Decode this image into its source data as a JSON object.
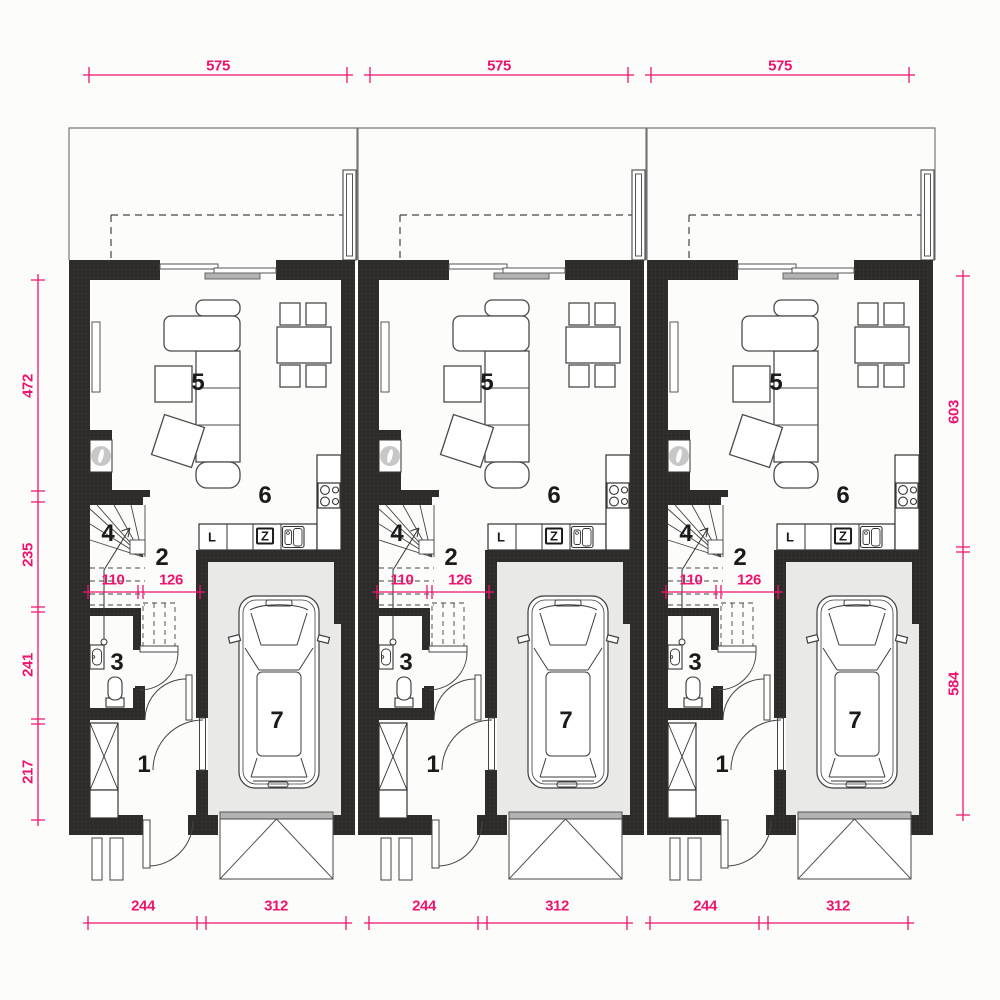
{
  "drawing": "ground floor plan of three identical terraced house units",
  "colors": {
    "dimension": "#ee146e",
    "wall": "#2d2c2a",
    "garage_floor": "#e9e9e7",
    "door_panel": "#b3b3b3",
    "background": "#fcfcfa"
  },
  "side_dims": {
    "left": [
      {
        "value": "472"
      },
      {
        "value": "235"
      },
      {
        "value": "241"
      },
      {
        "value": "217"
      }
    ],
    "right": [
      {
        "value": "603"
      },
      {
        "value": "584"
      }
    ]
  },
  "units": [
    {
      "rooms": {
        "r1": "1",
        "r2": "2",
        "r3": "3",
        "r4": "4",
        "r5": "5",
        "r6": "6",
        "r7": "7"
      },
      "kitchen": {
        "fridge": "L",
        "sink_unit": "Z"
      },
      "dims": {
        "width": "575",
        "front_left": "244",
        "front_right": "312",
        "stair": "110",
        "hall": "126"
      }
    },
    {
      "rooms": {
        "r1": "1",
        "r2": "2",
        "r3": "3",
        "r4": "4",
        "r5": "5",
        "r6": "6",
        "r7": "7"
      },
      "kitchen": {
        "fridge": "L",
        "sink_unit": "Z"
      },
      "dims": {
        "width": "575",
        "front_left": "244",
        "front_right": "312",
        "stair": "110",
        "hall": "126"
      }
    },
    {
      "rooms": {
        "r1": "1",
        "r2": "2",
        "r3": "3",
        "r4": "4",
        "r5": "5",
        "r6": "6",
        "r7": "7"
      },
      "kitchen": {
        "fridge": "L",
        "sink_unit": "Z"
      },
      "dims": {
        "width": "575",
        "front_left": "244",
        "front_right": "312",
        "stair": "110",
        "hall": "126"
      }
    }
  ]
}
